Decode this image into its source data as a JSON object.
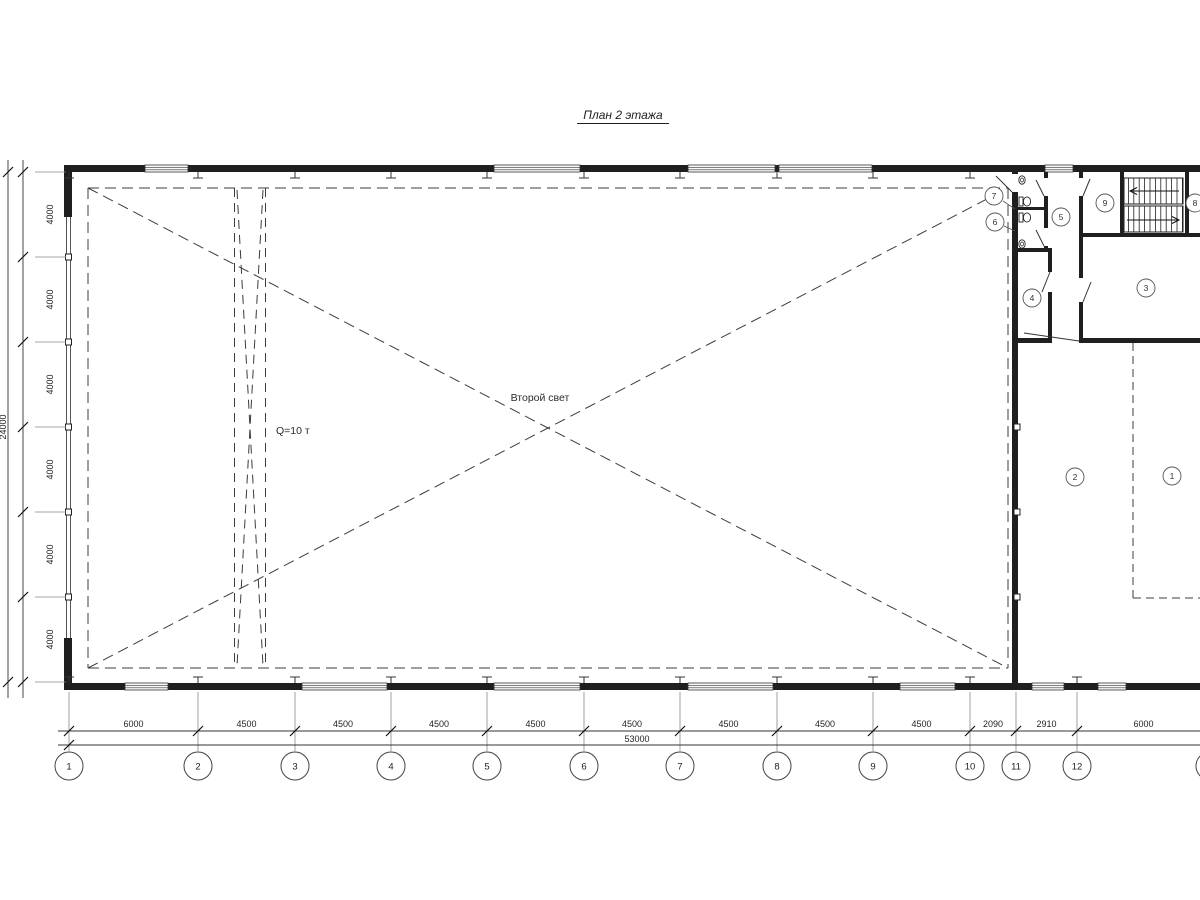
{
  "title": "План 2 этажа",
  "annotations": {
    "second_light": "Второй свет",
    "crane_capacity": "Q=10 т"
  },
  "dimensions": {
    "bottom_segments": [
      "6000",
      "4500",
      "4500",
      "4500",
      "4500",
      "4500",
      "4500",
      "4500",
      "4500",
      "2090",
      "2910",
      "6000"
    ],
    "bottom_total": "53000",
    "left_segments": [
      "4000",
      "4000",
      "4000",
      "4000",
      "4000",
      "4000"
    ],
    "left_total": "24000"
  },
  "grid_axes": {
    "bottom_labels": [
      "1",
      "2",
      "3",
      "4",
      "5",
      "6",
      "7",
      "8",
      "9",
      "10",
      "11",
      "12"
    ]
  },
  "rooms": [
    {
      "number": "7"
    },
    {
      "number": "6"
    },
    {
      "number": "5"
    },
    {
      "number": "9"
    },
    {
      "number": "8"
    },
    {
      "number": "4"
    },
    {
      "number": "3"
    },
    {
      "number": "2"
    },
    {
      "number": "1"
    }
  ],
  "icons": {
    "stairs": "stairs-icon",
    "toilet": "toilet-icon",
    "sink": "sink-icon"
  }
}
